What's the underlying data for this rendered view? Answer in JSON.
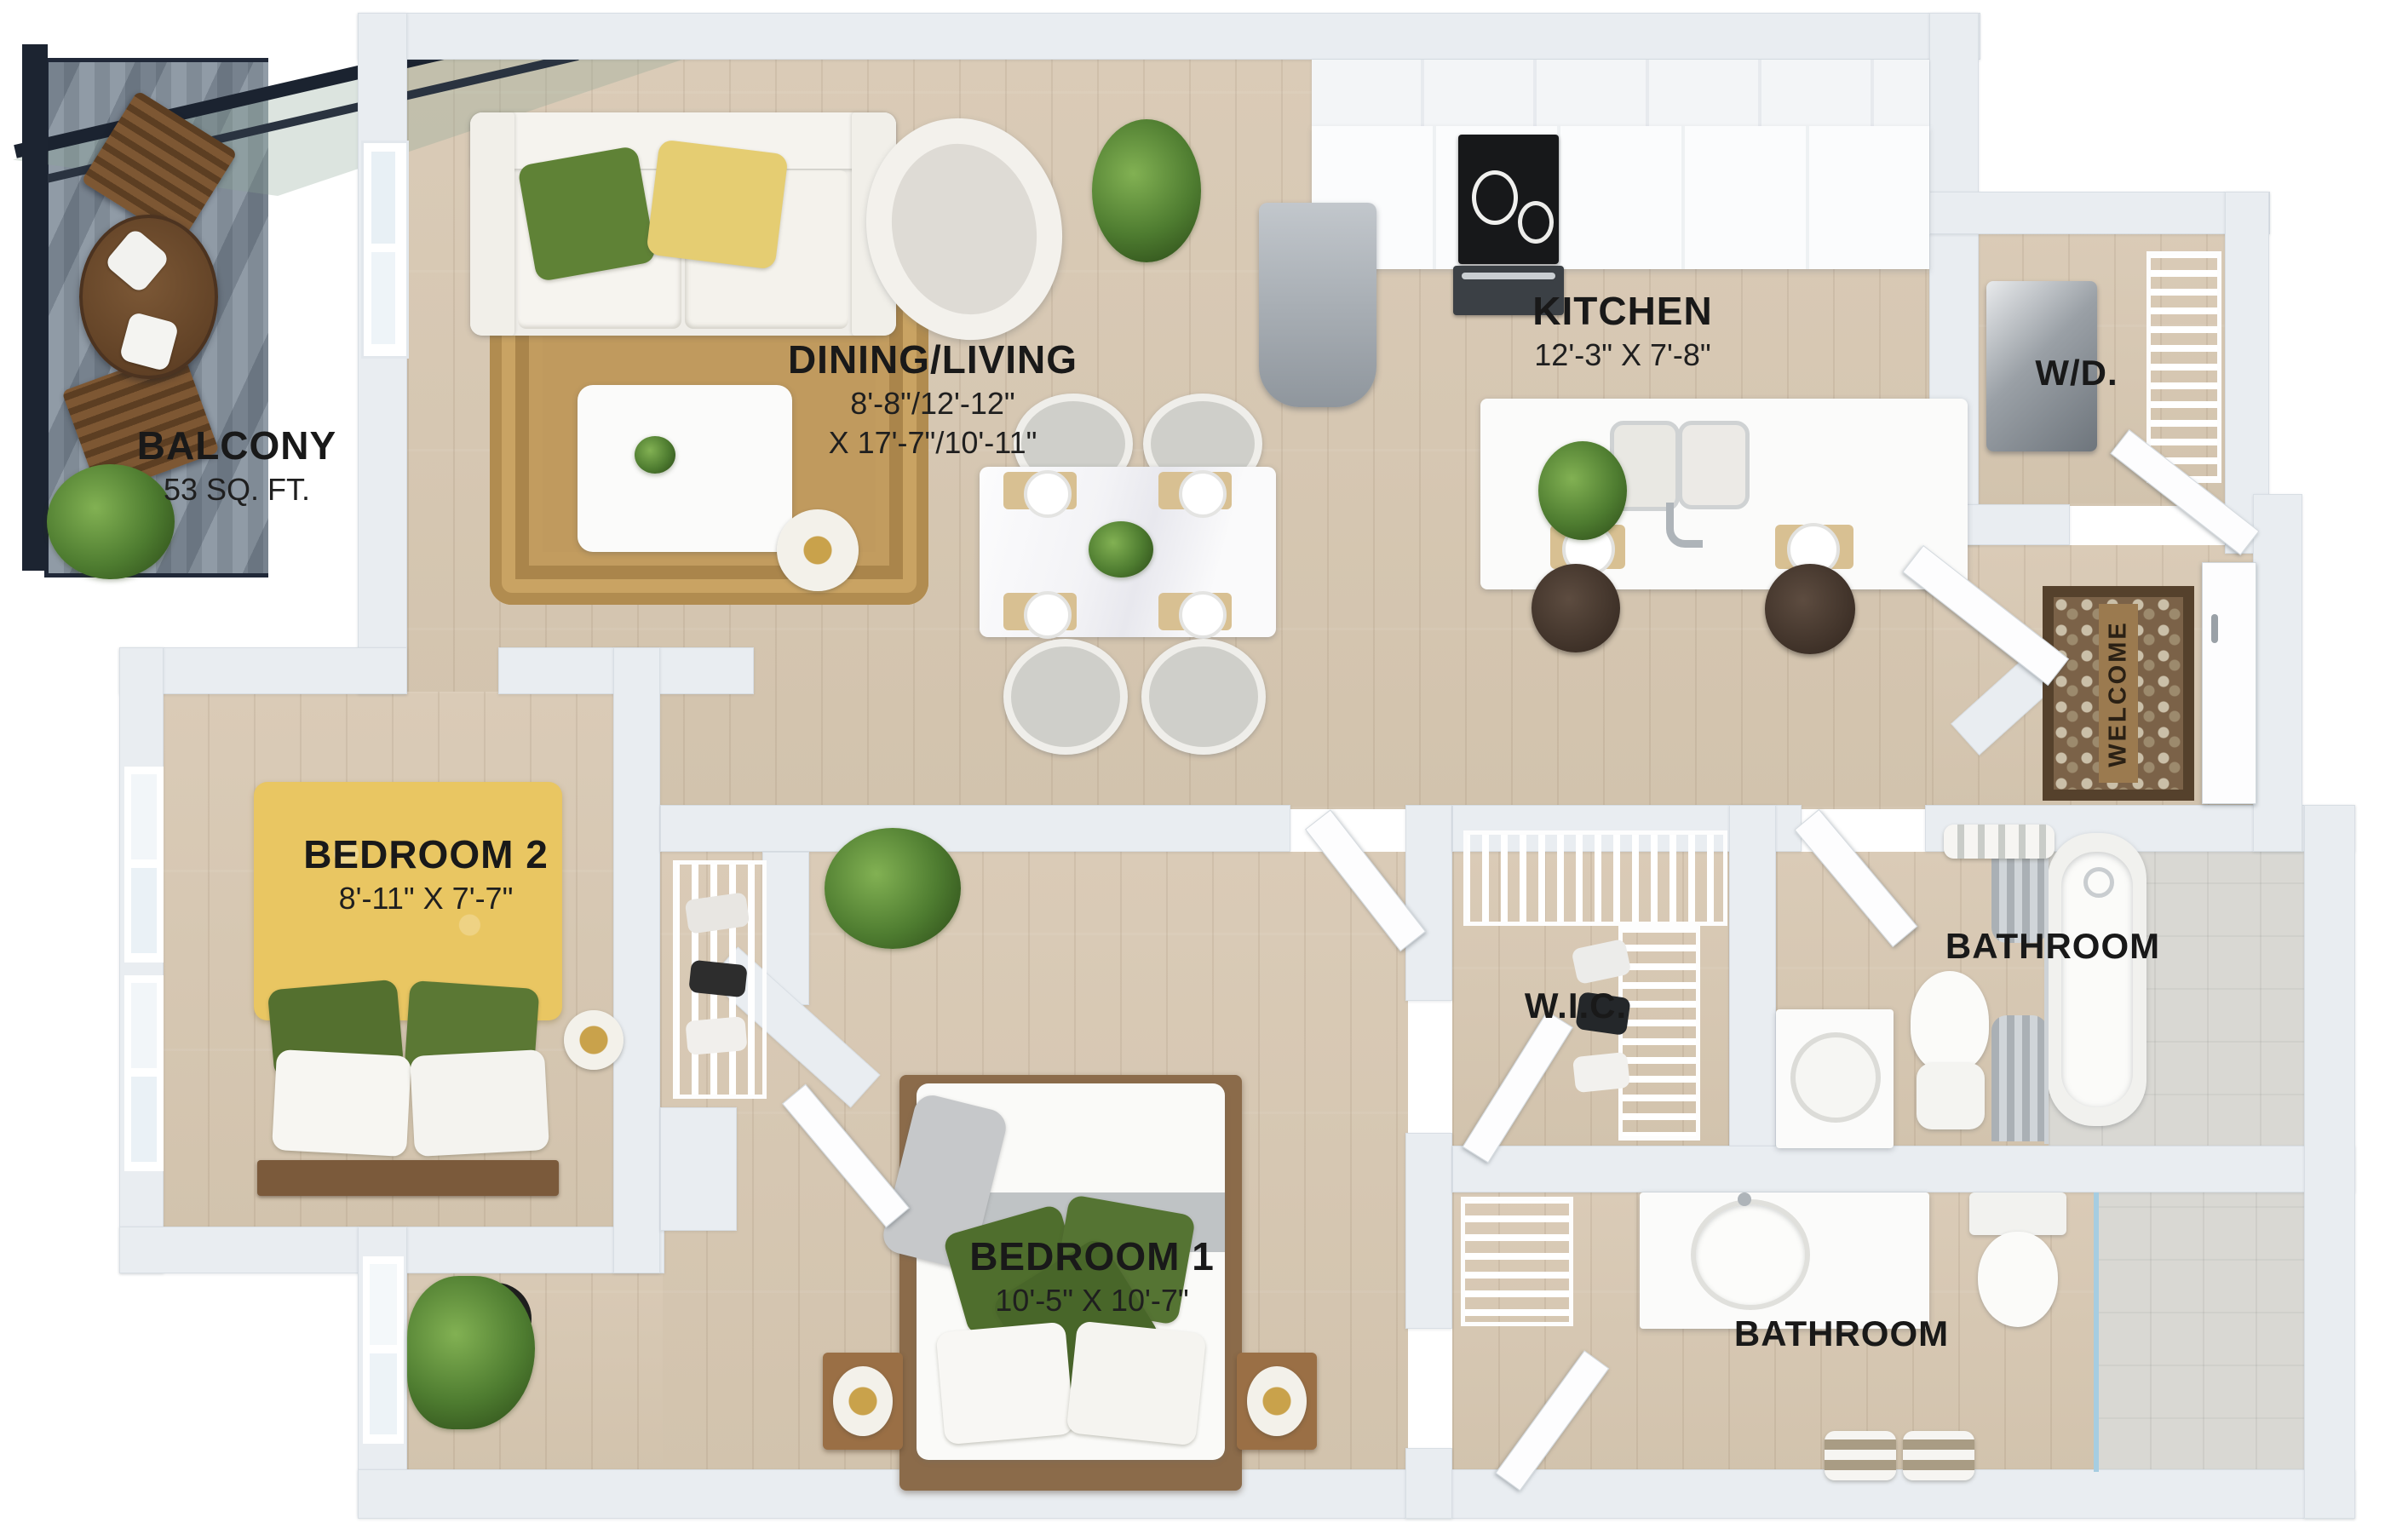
{
  "labels": {
    "balcony": {
      "name": "BALCONY",
      "dims": "53 SQ. FT."
    },
    "dining_living": {
      "name": "DINING/LIVING",
      "dims1": "8'-8\"/12'-12\"",
      "dims2": "X 17'-7\"/10'-11\""
    },
    "kitchen": {
      "name": "KITCHEN",
      "dims": "12'-3\" X 7'-8\""
    },
    "wd": {
      "name": "W/D."
    },
    "bedroom2": {
      "name": "BEDROOM 2",
      "dims": "8'-11\" X 7'-7\""
    },
    "bedroom1": {
      "name": "BEDROOM 1",
      "dims": "10'-5\" X 10'-7\""
    },
    "wic": {
      "name": "W.I.C."
    },
    "bathroom_top": {
      "name": "BATHROOM"
    },
    "bathroom_bottom": {
      "name": "BATHROOM"
    },
    "welcome_mat": {
      "text": "WELCOME"
    }
  },
  "colors": {
    "floor_wood": "#d6c7b2",
    "wall": "#e9edf1",
    "balcony_deck": "#8a95a0",
    "balcony_frame": "#202838",
    "bed_yellow": "#e9c662",
    "pillow_green": "#55722f",
    "rug_tan": "#c09a5e",
    "tile": "#d9d8d3",
    "label_text": "#191919"
  }
}
